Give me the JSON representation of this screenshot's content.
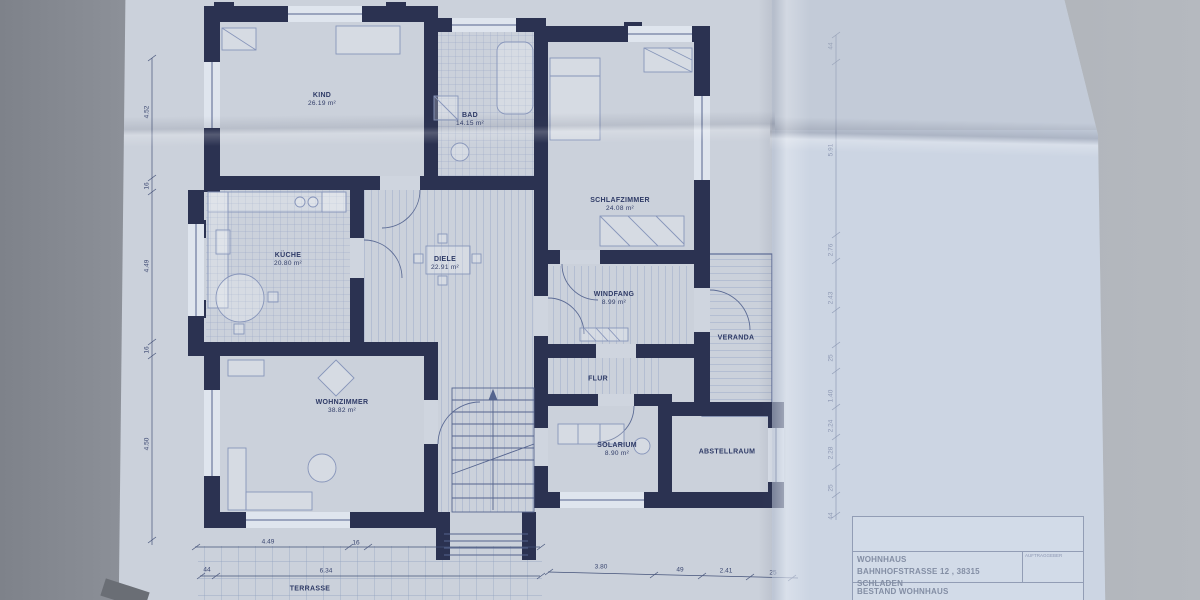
{
  "drawing": {
    "type": "floor-plan-scan",
    "paper_color": "#cbd1db",
    "wall_color": "#2b3251",
    "line_color": "#5d6c98",
    "text_color": "#2e3a66"
  },
  "rooms": [
    {
      "name": "KIND",
      "area": "26.19 m²"
    },
    {
      "name": "BAD",
      "area": "14.15 m²"
    },
    {
      "name": "SCHLAFZIMMER",
      "area": "24.08 m²"
    },
    {
      "name": "KÜCHE",
      "area": "20.80 m²"
    },
    {
      "name": "DIELE",
      "area": "22.91 m²"
    },
    {
      "name": "WINDFANG",
      "area": "8.99 m²"
    },
    {
      "name": "VERANDA",
      "area": ""
    },
    {
      "name": "WOHNZIMMER",
      "area": "38.82 m²"
    },
    {
      "name": "FLUR",
      "area": ""
    },
    {
      "name": "SOLARIUM",
      "area": "8.90 m²"
    },
    {
      "name": "ABSTELLRAUM",
      "area": ""
    },
    {
      "name": "TERRASSE",
      "area": ""
    }
  ],
  "dims": {
    "left": [
      "4.52",
      "16",
      "4.49",
      "16",
      "4.50"
    ],
    "right": [
      "44",
      "5.91",
      "2.76",
      "2.43",
      "25",
      "1.40",
      "2.24",
      "2.28",
      "25",
      "44"
    ],
    "bottom": [
      "4.49",
      "16",
      "44",
      "6.34",
      "3.80",
      "49",
      "2.41",
      "25"
    ]
  },
  "title_block": {
    "project_line1": "WOHNHAUS",
    "project_line2": "BAHNHOFSTRASSE 12 , 38315 SCHLADEN",
    "subtitle": "BESTAND WOHNHAUS",
    "corner_label": "AUFTRAGGEBER"
  }
}
